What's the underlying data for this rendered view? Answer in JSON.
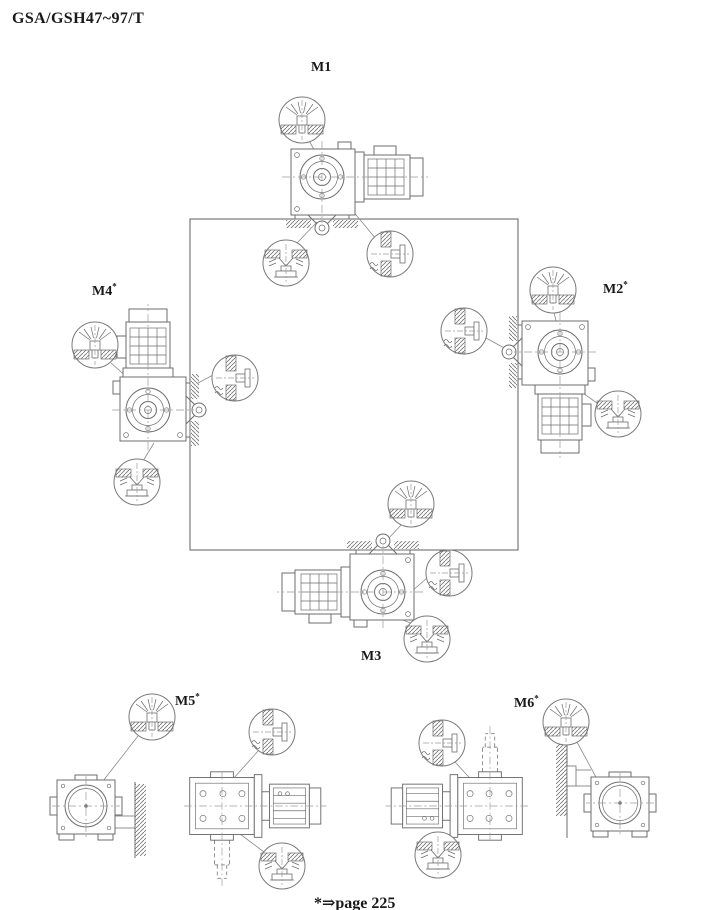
{
  "page": {
    "title": "GSA/GSH47~97/T",
    "footnote": "*⇒page 225"
  },
  "positions": [
    {
      "id": "m1",
      "label": "M1",
      "star": ""
    },
    {
      "id": "m2",
      "label": "M2",
      "star": "*"
    },
    {
      "id": "m3",
      "label": "M3",
      "star": ""
    },
    {
      "id": "m4",
      "label": "M4",
      "star": "*"
    },
    {
      "id": "m5",
      "label": "M5",
      "star": "*"
    },
    {
      "id": "m6",
      "label": "M6",
      "star": "*"
    }
  ],
  "detail_symbols": {
    "breather": "breather-valve-icon",
    "oil_level": "oil-level-plug-icon",
    "oil_drain": "oil-drain-plug-icon"
  },
  "colors": {
    "background": "#ffffff",
    "line": "#6e6e6e",
    "text": "#1a1a1a"
  }
}
